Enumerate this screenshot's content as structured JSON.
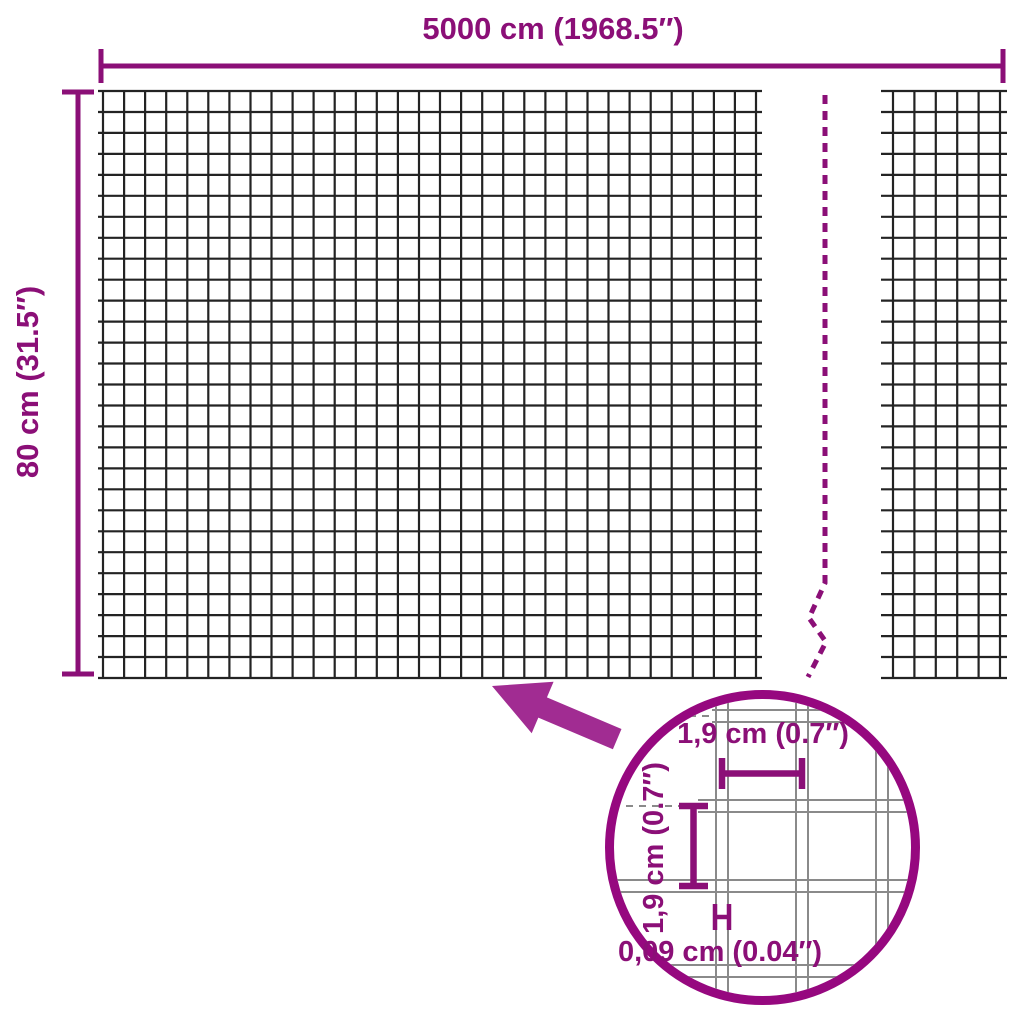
{
  "diagram": {
    "dimensions": {
      "width_label": "5000 cm (1968.5″)",
      "height_label": "80 cm (31.5″)"
    },
    "detail_view": {
      "mesh_width_label": "1,9 cm (0.7″)",
      "mesh_height_label": "1,9 cm (0.7″)",
      "wire_thickness_label": "0,09 cm (0.04″)"
    },
    "colors": {
      "dimension_purple": "#8B0F77",
      "arrow_purple": "#A12C92",
      "circle_purple": "#96087F",
      "mesh_dark": "#232323",
      "detail_mesh_gray": "#8A8A8A",
      "background": "#FFFFFF"
    }
  }
}
